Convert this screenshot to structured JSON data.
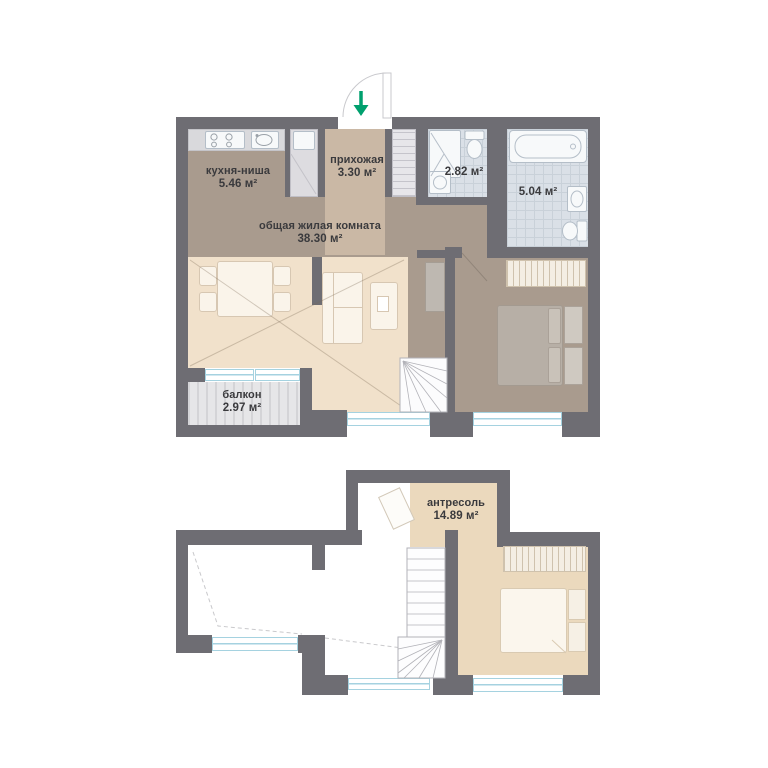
{
  "colors": {
    "wall": "#6e6d73",
    "taupe": "#a99b8e",
    "hall": "#cab8a5",
    "beige": "#f1e1cb",
    "mezz": "#ebd9bd",
    "tile": "#dae0e7",
    "tileline": "#c9d1d9",
    "counter": "#d9d9dc",
    "closet": "#dddce0",
    "balcony": "#e6e6e8",
    "stripe": "#d4d4d7",
    "window": "#a5d2e0",
    "green": "#00a06e",
    "text": "#3a3a3d",
    "furn": "#faf4ea",
    "furnline": "#d7c7b2",
    "fixture": "#f7f9fa",
    "fixline": "#b4bec8",
    "bed": "#b7afa6"
  },
  "floor1": {
    "kitchen": {
      "name": "кухня-ниша",
      "area": "5.46 м²"
    },
    "hallway": {
      "name": "прихожая",
      "area": "3.30 м²"
    },
    "bathroom_small": {
      "area": "2.82 м²"
    },
    "bathroom_large": {
      "area": "5.04 м²"
    },
    "living": {
      "name": "общая жилая комната",
      "area": "38.30 м²"
    },
    "balcony": {
      "name": "балкон",
      "area": "2.97 м²"
    }
  },
  "floor2": {
    "mezzanine": {
      "name": "антресоль",
      "area": "14.89 м²"
    }
  }
}
